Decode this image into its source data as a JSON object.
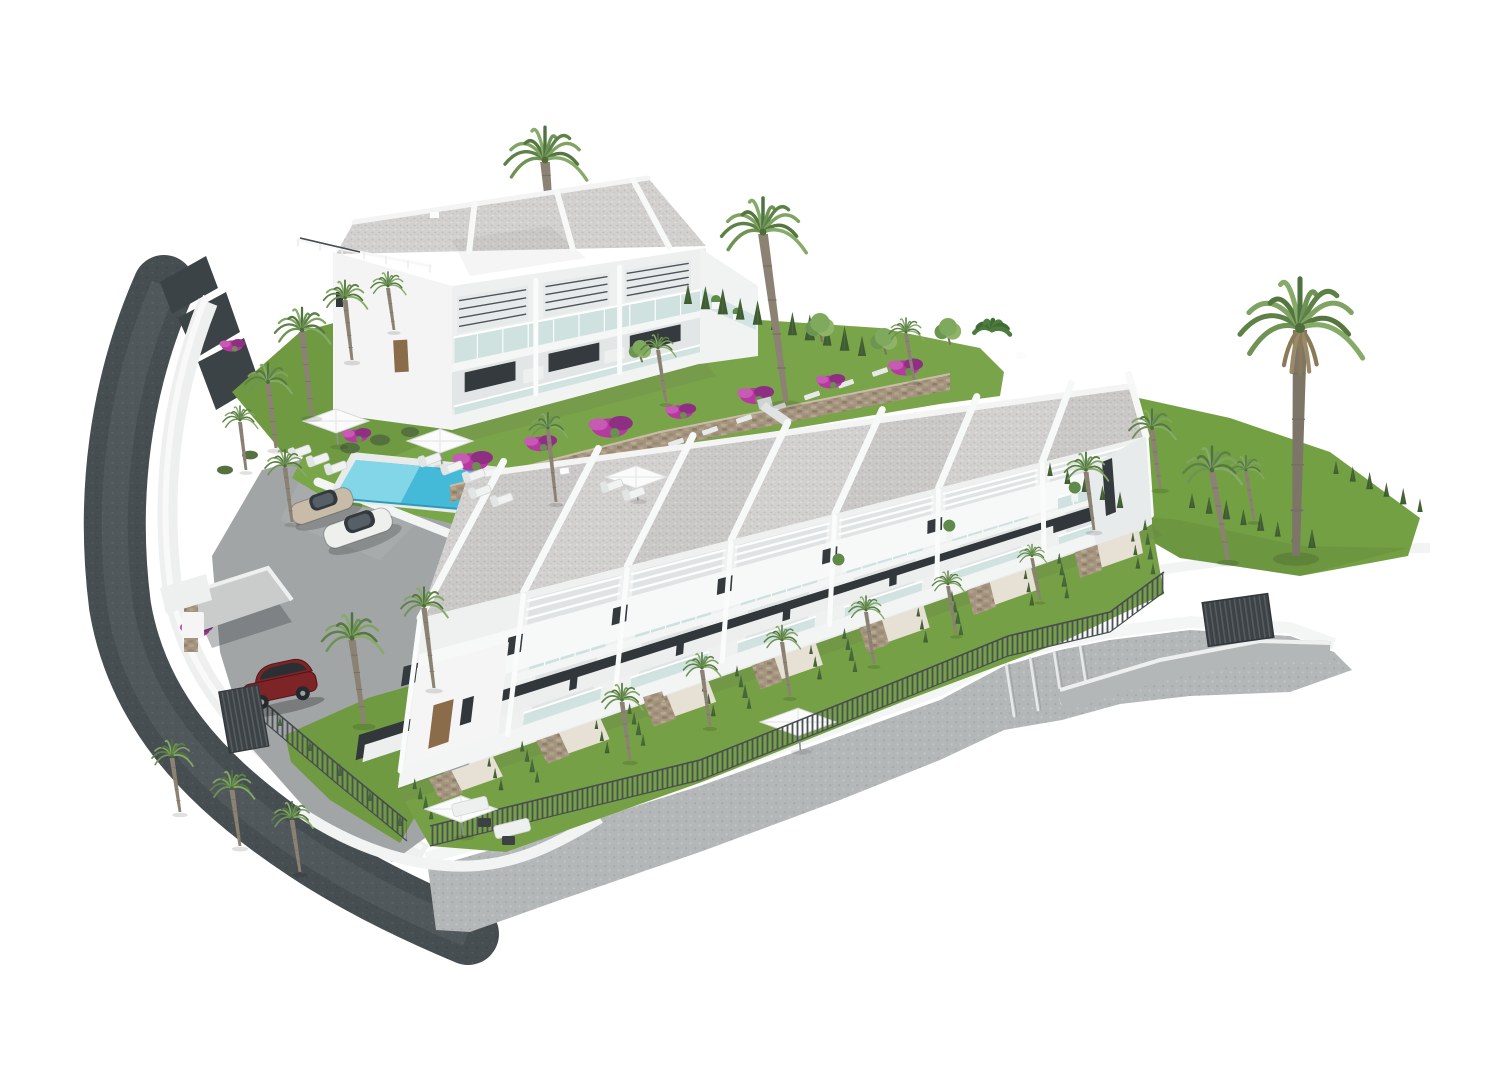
{
  "scene": {
    "type": "3d-architectural-render",
    "label": "Aerial 3D rendering of a Mediterranean residential development on a white background",
    "background_color": "#ffffff"
  },
  "buildings": {
    "villa_block": {
      "label": "Two-storey villa block with stepped gravel roof decks, louvred shades, glass balconies and terraces",
      "storeys": 2,
      "visible_units": 3,
      "wall_color": "#f2f3f2",
      "roof_color": "#d2d1cf"
    },
    "townhouse_row": {
      "label": "Terraced row of seven two-storey townhouses with slanted gravel roof slabs, white pergola beams, glass balconies and private rear gardens",
      "storeys": 2,
      "visible_units": 7,
      "wall_color": "#f1f2f2",
      "roof_color": "#d0cfcd"
    }
  },
  "amenities": {
    "swimming_pool": {
      "label": "Rectangular community swimming pool",
      "water_color": "#45bad8",
      "shallow_color": "#8edbea"
    },
    "sun_loungers": {
      "count": 12,
      "color": "#f0f2f2"
    },
    "parasols": {
      "count": 5,
      "color": "#fafbfa"
    },
    "lounge_set": {
      "label": "Garden lounge set with white sofas and dark coffee tables"
    },
    "playground": {
      "label": "Small playground with slide in the shared garden"
    },
    "barbecue": {
      "label": "Stone outdoor kitchen on a ground-floor terrace"
    }
  },
  "vehicles": {
    "parked_cars": [
      {
        "label": "beige sedan in guest parking",
        "color": "#c8bca8"
      },
      {
        "label": "white sedan in guest parking",
        "color": "#eef0ee"
      },
      {
        "label": "dark red hatchback under carport",
        "color": "#7d2427"
      }
    ]
  },
  "landscape": {
    "lawn_color": "#76a045",
    "palm_trees": {
      "count": 28,
      "frond_colors": [
        "#6e9355",
        "#5d8147",
        "#7fa362"
      ],
      "trunk_color": "#8b8274"
    },
    "cypress_hedges": {
      "color": "#3f5c33"
    },
    "bougainvillea": {
      "colors": [
        "#b5399f",
        "#8f2f84"
      ]
    },
    "stone_retaining_wall": {
      "color": "#a59580"
    }
  },
  "infrastructure": {
    "access_road": {
      "label": "Curved dark asphalt access road with white retaining walls",
      "asphalt_color": "#474e52"
    },
    "parking_area": {
      "label": "Paved guest parking beside the pool",
      "paving_color": "#a2a5a6"
    },
    "promenade": {
      "label": "Cobbled perimeter footpath with steps",
      "paving_color": "#b4b7b8"
    },
    "fences": {
      "label": "Dark metal picket fences and slatted gates",
      "color": "#4a5054"
    },
    "carport": {
      "label": "Carport with stone pillar and slatted gate"
    }
  }
}
